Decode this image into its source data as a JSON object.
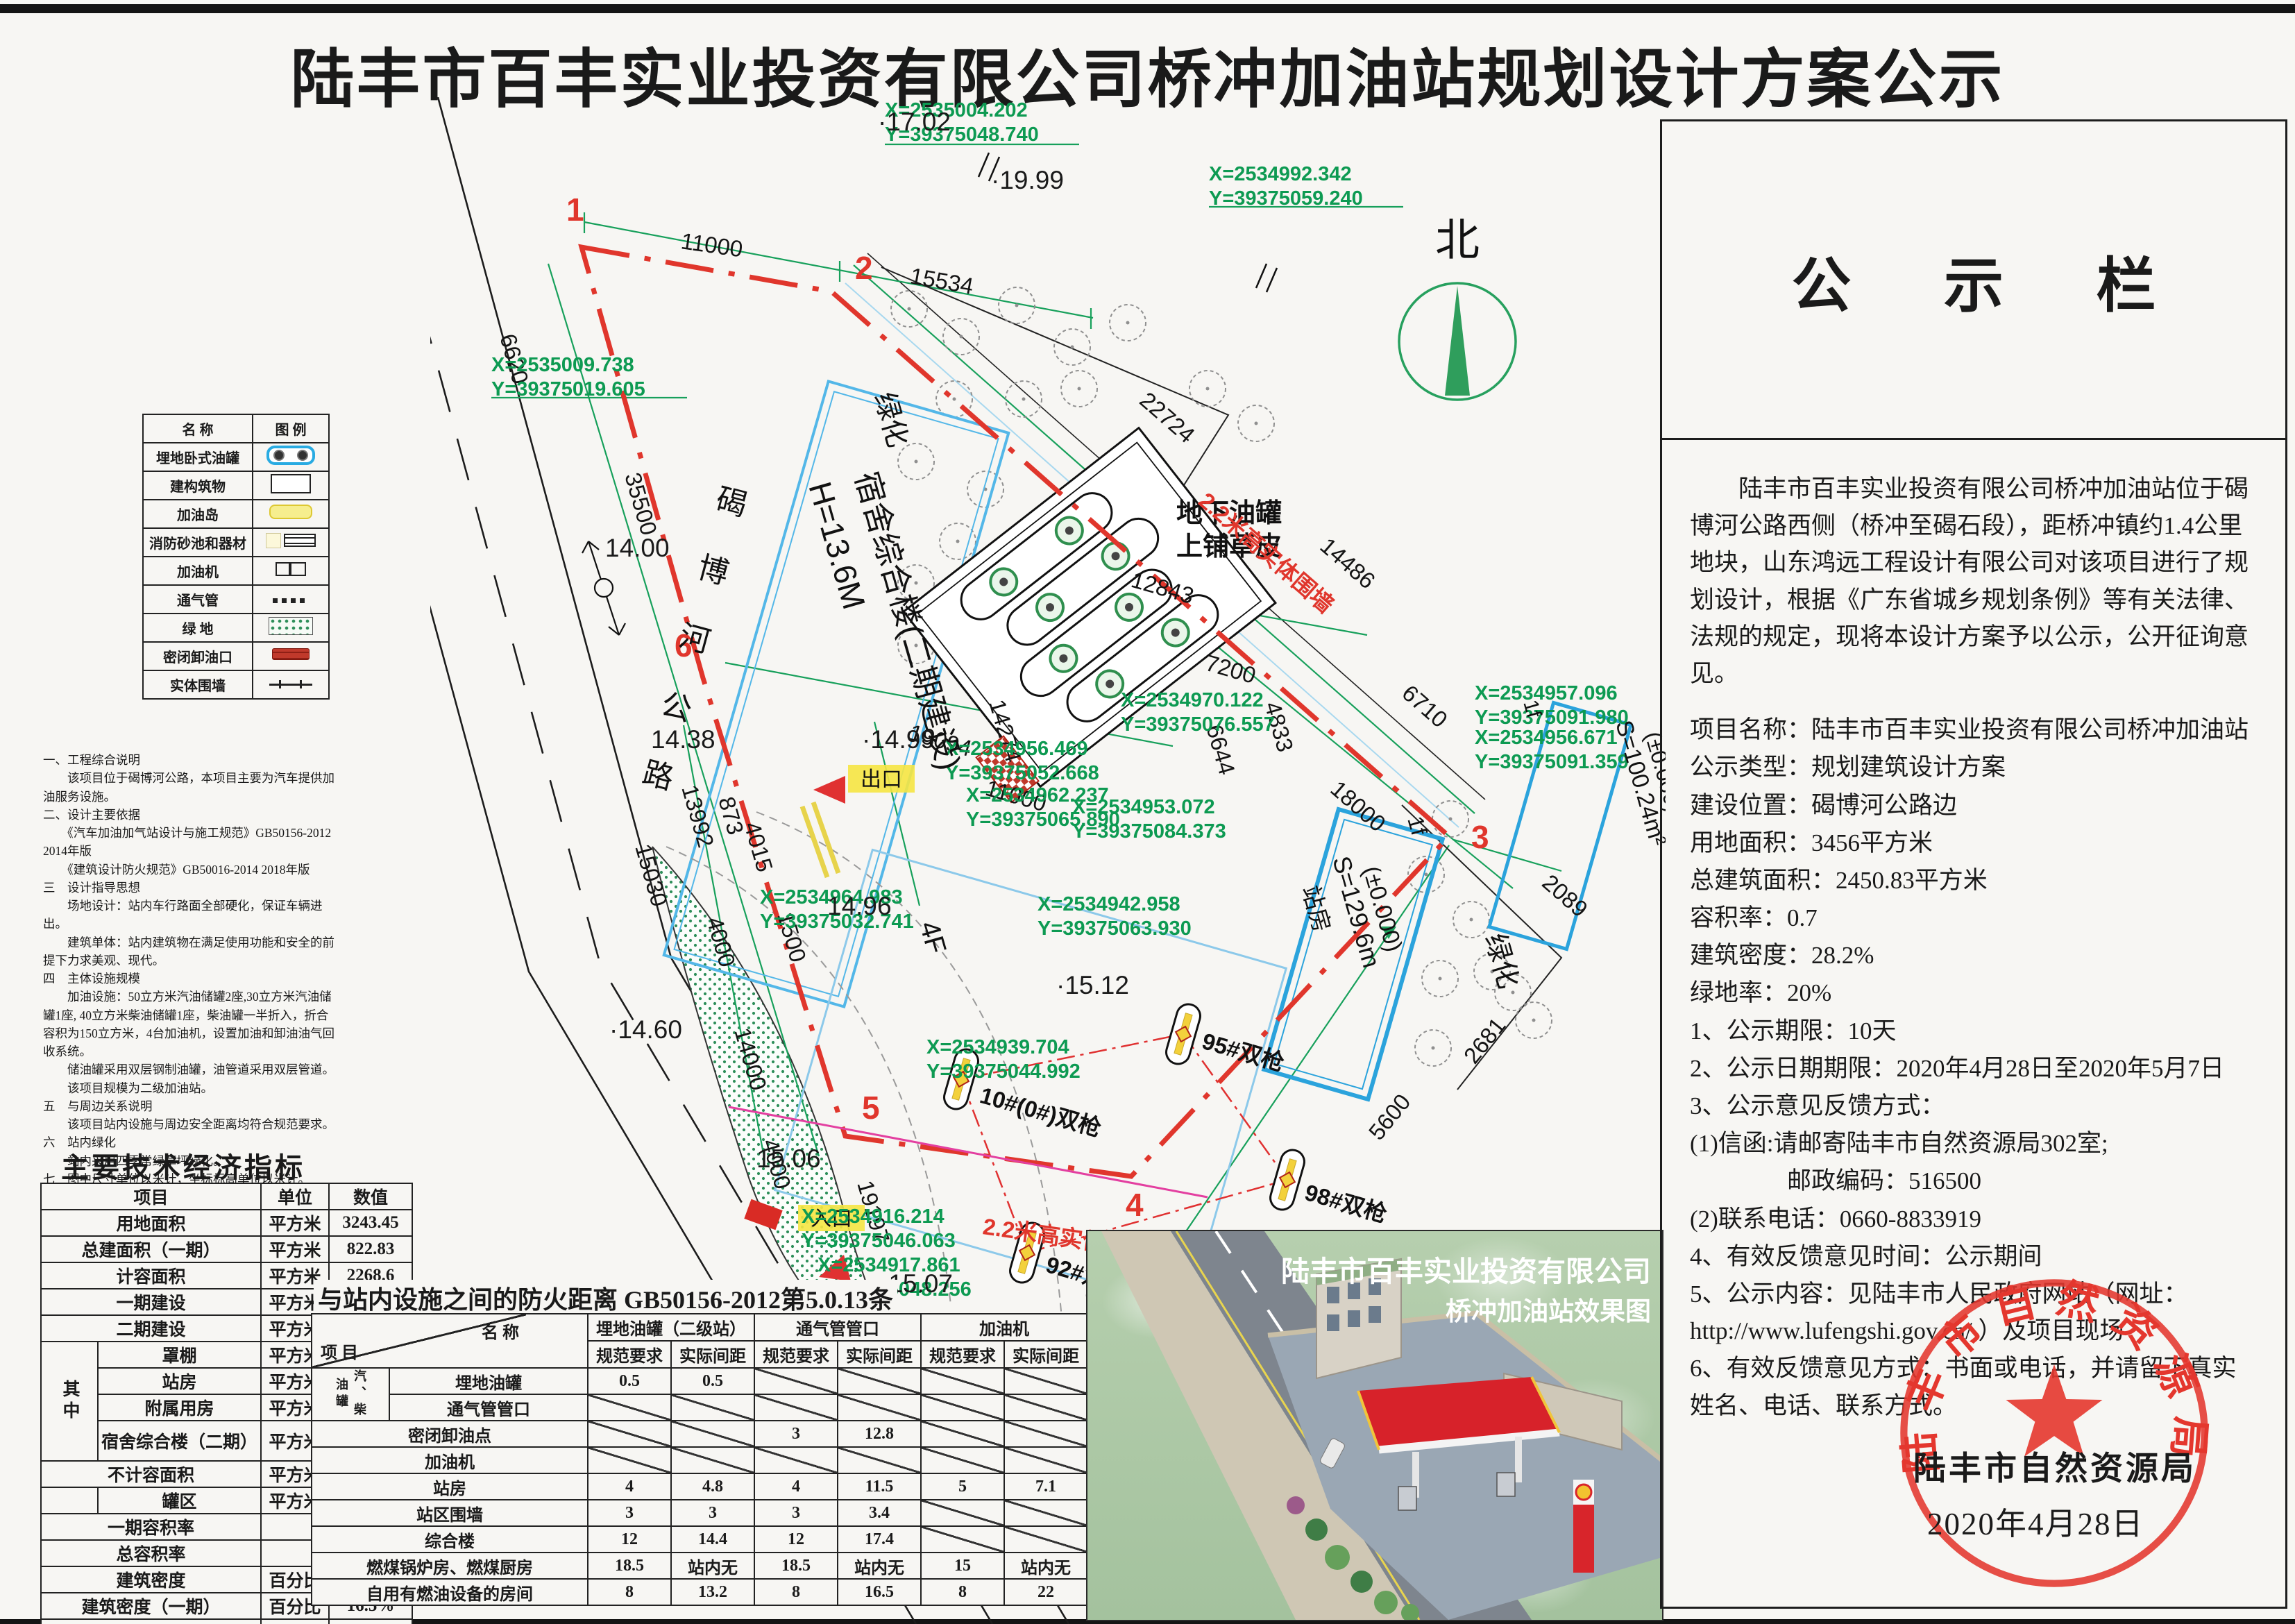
{
  "page_title": "陆丰市百丰实业投资有限公司桥冲加油站规划设计方案公示",
  "board": {
    "title": "公 示 栏",
    "paragraph": "陆丰市百丰实业投资有限公司桥冲加油站位于碣博河公路西侧（桥冲至碣石段），距桥冲镇约1.4公里地块，山东鸿远工程设计有限公司对该项目进行了规划设计，根据《广东省城乡规划条例》等有关法律、法规的规定，现将本设计方案予以公示，公开征询意见。",
    "lines": [
      "项目名称：陆丰市百丰实业投资有限公司桥冲加油站",
      "公示类型：规划建筑设计方案",
      "建设位置：碣博河公路边",
      "用地面积：3456平方米",
      "总建筑面积：2450.83平方米",
      "容积率：0.7",
      "建筑密度：28.2%",
      "绿地率：20%",
      "1、公示期限：10天",
      "2、公示日期期限：2020年4月28日至2020年5月7日",
      "3、公示意见反馈方式：",
      "(1)信函:请邮寄陆丰市自然资源局302室;",
      "　　　　邮政编码：516500",
      "(2)联系电话：0660-8833919",
      "4、有效反馈意见时间：公示期间",
      "5、公示内容：见陆丰市人民政府网站（网址： http://www.lufengshi.gov.cn/ ）及项目现场",
      "6、有效反馈意见方式：书面或电话，并请留下真实姓名、电话、联系方式。"
    ]
  },
  "seal": {
    "ring": "陆丰市自然资源局",
    "agency": "陆丰市自然资源局",
    "date": "2020年4月28日"
  },
  "legend": {
    "header_name": "名    称",
    "header_icon": "图    例",
    "rows": [
      {
        "label": "埋地卧式油罐"
      },
      {
        "label": "建构筑物"
      },
      {
        "label": "加油岛"
      },
      {
        "label": "消防砂池和器材"
      },
      {
        "label": "加油机"
      },
      {
        "label": "通气管"
      },
      {
        "label": "绿  地"
      },
      {
        "label": "密闭卸油口"
      },
      {
        "label": "实体围墙"
      }
    ]
  },
  "notes": {
    "lines": [
      "一、工程综合说明",
      "　　该项目位于碣博河公路，本项目主要为汽车提供加油服务设施。",
      "二、设计主要依据",
      "　　《汽车加油加气站设计与施工规范》GB50156-2012 2014年版",
      "　　《建筑设计防火规范》GB50016-2014 2018年版",
      "三　设计指导思想",
      "　　场地设计：站内车行路面全部硬化，保证车辆进出。",
      "　　建筑单体：站内建筑物在满足使用功能和安全的前提下力求美观、现代。",
      "四　主体设施规模",
      "　　加油设施：50立方米汽油储罐2座,30立方米汽油储罐1座, 40立方米柴油储罐1座，柴油罐一半折入，折合容积为150立方米，4台加油机，设置加油和卸油油气回收系统。",
      "　　储油罐采用双层钢制油罐，油管道采用双层管道。",
      "　　该项目规模为二级加油站。",
      "五　与周边关系说明",
      "　　该项目站内设施与周边安全距离均符合规范要求。",
      "六　站内绿化",
      "　　站内采用四季常绿草坪绿化。",
      "七　图中尺寸单位以米计，坐标标高单位以米计。"
    ]
  },
  "indicators": {
    "title": "主要技术经济指标",
    "h_item": "项目",
    "h_unit": "单位",
    "h_value": "数值",
    "zhong": "其中",
    "rows": [
      {
        "label": "用地面积",
        "unit": "平方米",
        "value": "3243.45"
      },
      {
        "label": "总建面积（一期）",
        "unit": "平方米",
        "value": "822.83"
      },
      {
        "label": "计容面积",
        "unit": "平方米",
        "value": "2268.6"
      },
      {
        "label": "一期建设",
        "unit": "平方米",
        "value": "640.6"
      },
      {
        "label": "二期建设",
        "unit": "平方米",
        "value": "1628"
      },
      {
        "label": "罩棚",
        "unit": "平方米",
        "value": "411"
      },
      {
        "label": "站房",
        "unit": "平方米",
        "value": "129.6"
      },
      {
        "label": "附属用房",
        "unit": "平方米",
        "value": "100"
      },
      {
        "label": "宿舍综合楼（二期）",
        "unit": "平方米",
        "value": "1628"
      },
      {
        "label": "不计容面积",
        "unit": "平方米",
        "value": "182.23"
      },
      {
        "label": "罐区",
        "unit": "平方米",
        "value": "182.23"
      },
      {
        "label": "一期容积率",
        "unit": "",
        "value": "0.198"
      },
      {
        "label": "总容积率",
        "unit": "",
        "value": "0.699"
      },
      {
        "label": "建筑密度",
        "unit": "百分比",
        "value": "28.2%"
      },
      {
        "label": "建筑密度（一期）",
        "unit": "百分比",
        "value": "16.5%"
      },
      {
        "label": "绿地率",
        "unit": "百分比",
        "value": "20%"
      }
    ]
  },
  "fire": {
    "title": "与站内设施之间的防火距离 GB50156-2012第5.0.13条",
    "corner_a": "名    称",
    "corner_b": "项  目",
    "groups": [
      "埋地油罐（二级站）",
      "通气管管口",
      "加油机"
    ],
    "sub": [
      "规范要求",
      "实际间距"
    ],
    "side_group": "汽、柴油罐",
    "rows": [
      {
        "label": "埋地油罐",
        "v": [
          "0.5",
          "0.5",
          "/",
          "/",
          "/",
          "/"
        ]
      },
      {
        "label": "通气管管口",
        "v": [
          "/",
          "/",
          "/",
          "/",
          "/",
          "/"
        ]
      },
      {
        "label": "密闭卸油点",
        "v": [
          "/",
          "/",
          "3",
          "12.8",
          "/",
          "/"
        ]
      },
      {
        "label": "加油机",
        "v": [
          "/",
          "/",
          "/",
          "/",
          "/",
          "/"
        ]
      },
      {
        "label": "站房",
        "v": [
          "4",
          "4.8",
          "4",
          "11.5",
          "5",
          "7.1"
        ]
      },
      {
        "label": "站区围墙",
        "v": [
          "3",
          "3",
          "3",
          "3.4",
          "/",
          "/"
        ]
      },
      {
        "label": "综合楼",
        "v": [
          "12",
          "14.4",
          "12",
          "17.4",
          "/",
          "/"
        ]
      },
      {
        "label": "燃煤锅炉房、燃煤厨房",
        "v": [
          "18.5",
          "站内无",
          "18.5",
          "站内无",
          "15",
          "站内无"
        ]
      },
      {
        "label": "自用有燃油设备的房间",
        "v": [
          "8",
          "13.2",
          "8",
          "16.5",
          "8",
          "22"
        ]
      }
    ]
  },
  "render3d": {
    "caption1": "陆丰市百丰实业投资有限公司",
    "caption2": "桥冲加油站效果图"
  },
  "site_plan": {
    "north": "北",
    "road_name": "碣博河公路",
    "corners": [
      "1",
      "2",
      "3",
      "4",
      "5",
      "6"
    ],
    "dims": [
      "6620",
      "11000",
      "15534",
      "22724",
      "14486",
      "6710",
      "18000",
      "2089",
      "2681",
      "5600",
      "35500",
      "15030",
      "13992",
      "873",
      "4015",
      "19094",
      "14274",
      "7200",
      "4833",
      "6644",
      "12843",
      "11000",
      "1500",
      "4000",
      "14000",
      "4000",
      "19197"
    ],
    "coords": [
      [
        "X=2535004.202",
        "Y=39375048.740"
      ],
      [
        "X=2535009.738",
        "Y=39375019.605"
      ],
      [
        "X=2534992.342",
        "Y=39375059.240"
      ],
      [
        "X=2534964.983",
        "Y=39375032.741"
      ],
      [
        "X=2534956.469",
        "Y=39375052.668"
      ],
      [
        "X=2534962.237",
        "Y=39375065.890"
      ],
      [
        "X=2534970.122",
        "Y=39375076.557"
      ],
      [
        "X=2534953.072",
        "Y=39375084.373"
      ],
      [
        "X=2534942.958",
        "Y=39375063.930"
      ],
      [
        "X=2534939.704",
        "Y=39375044.992"
      ],
      [
        "X=2534916.214",
        "Y=39375046.063"
      ],
      [
        "X=2534917.861",
        "Y=39375048.256"
      ],
      [
        "X=2534957.096",
        "Y=39375091.980"
      ],
      [
        "X=2534956.671",
        "Y=39375091.359"
      ]
    ],
    "elevations": [
      "·17.02",
      "·19.99",
      "14.00",
      "14.38",
      "·14.99",
      "14.96",
      "·14.60",
      "15.06",
      "·15.07",
      "15.17",
      "·15.12",
      "·15.07"
    ],
    "labels": {
      "dorm1": "H=13.6M",
      "dorm2": "宿舍综合楼(二期建设)",
      "dorm_floor": "4F",
      "tank1": "地下油罐",
      "tank2": "上铺草皮",
      "station": "站房",
      "station_area": "S=129.6m",
      "station_elev": "(±0.000)",
      "station_floor": "1f",
      "aux_area": "S=100.24m²",
      "aux_elev": "(±0.000)",
      "aux_floor": "1f",
      "green": "绿化",
      "wall": "2.2米高实体围墙",
      "exit": "出口",
      "entrance": "入口"
    },
    "dispensers": [
      "10#(0#)双枪",
      "95#双枪",
      "92#双枪",
      "98#双枪"
    ]
  }
}
